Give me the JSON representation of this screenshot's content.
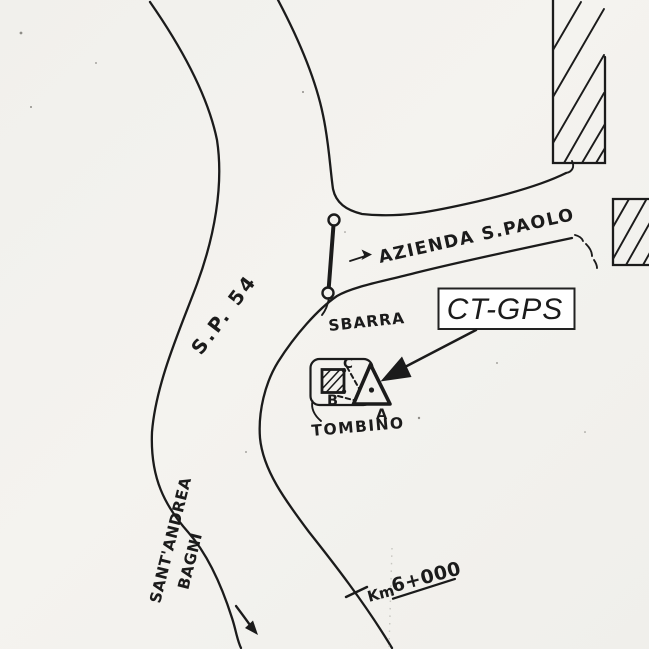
{
  "station_callout": {
    "label": "CT-GPS"
  },
  "roads": {
    "main_label": "S.P. 54",
    "branch_label": "AZIENDA S.PAOLO"
  },
  "barrier": {
    "label": "SBARRA"
  },
  "manhole": {
    "label": "TOMBINO"
  },
  "survey_points": {
    "a": "A",
    "b": "B",
    "c": "C"
  },
  "km_marker": {
    "prefix": "Km",
    "value": "6+000"
  },
  "destination": {
    "line1": "SANT'ANDREA",
    "line2": "BAGNI"
  },
  "colors": {
    "ink": "#1b1b1b",
    "paper": "#f2f1ed",
    "callout_bg": "#ffffff"
  }
}
